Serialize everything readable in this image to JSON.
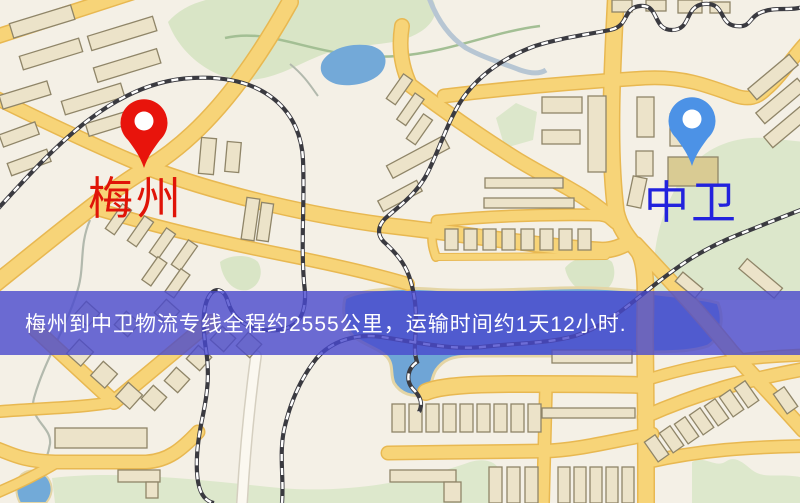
{
  "map": {
    "origin": {
      "name": "梅州",
      "pin_color": "#e8140c",
      "label_color": "#e01408"
    },
    "destination": {
      "name": "中卫",
      "pin_color": "#4c92e6",
      "label_color": "#2222dd"
    },
    "banner": {
      "text": "梅州到中卫物流专线全程约2555公里，运输时间约1天12小时.",
      "background_color": "#4848cd",
      "text_color": "#ffffff"
    },
    "legend_colors": {
      "background": "#f4f0e6",
      "road": "#f7d478",
      "road_border": "#e8b851",
      "water": "#6fa5d6",
      "park": "#d9e5c6",
      "railway": "#3a3a40",
      "building": "#ece3c9"
    }
  }
}
